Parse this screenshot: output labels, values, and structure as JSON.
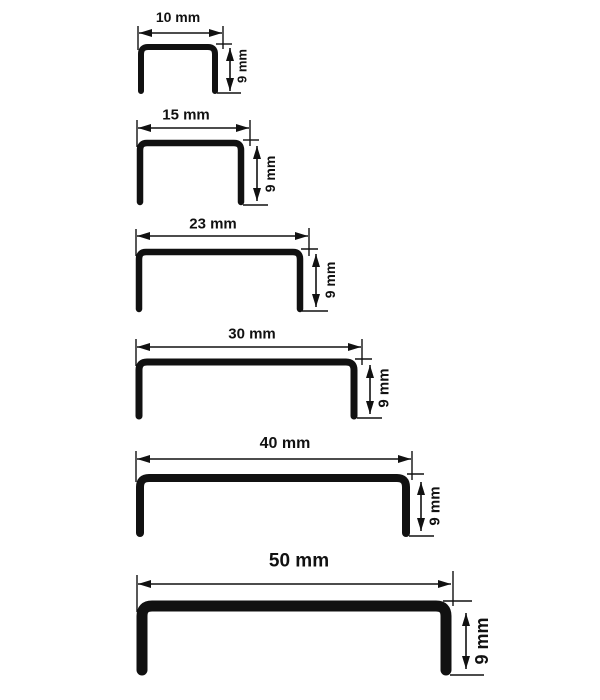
{
  "diagram": {
    "name": "U-channel profile dimension drawings",
    "unit": "mm",
    "colors": {
      "line": "#111111",
      "background": "#ffffff"
    },
    "profiles": [
      {
        "width_label": "10 mm",
        "height_label": "9 mm",
        "width_mm": 10,
        "height_mm": 9
      },
      {
        "width_label": "15 mm",
        "height_label": "9 mm",
        "width_mm": 15,
        "height_mm": 9
      },
      {
        "width_label": "23 mm",
        "height_label": "9 mm",
        "width_mm": 23,
        "height_mm": 9
      },
      {
        "width_label": "30 mm",
        "height_label": "9 mm",
        "width_mm": 30,
        "height_mm": 9
      },
      {
        "width_label": "40 mm",
        "height_label": "9 mm",
        "width_mm": 40,
        "height_mm": 9
      },
      {
        "width_label": "50 mm",
        "height_label": "9 mm",
        "width_mm": 50,
        "height_mm": 9
      }
    ]
  }
}
